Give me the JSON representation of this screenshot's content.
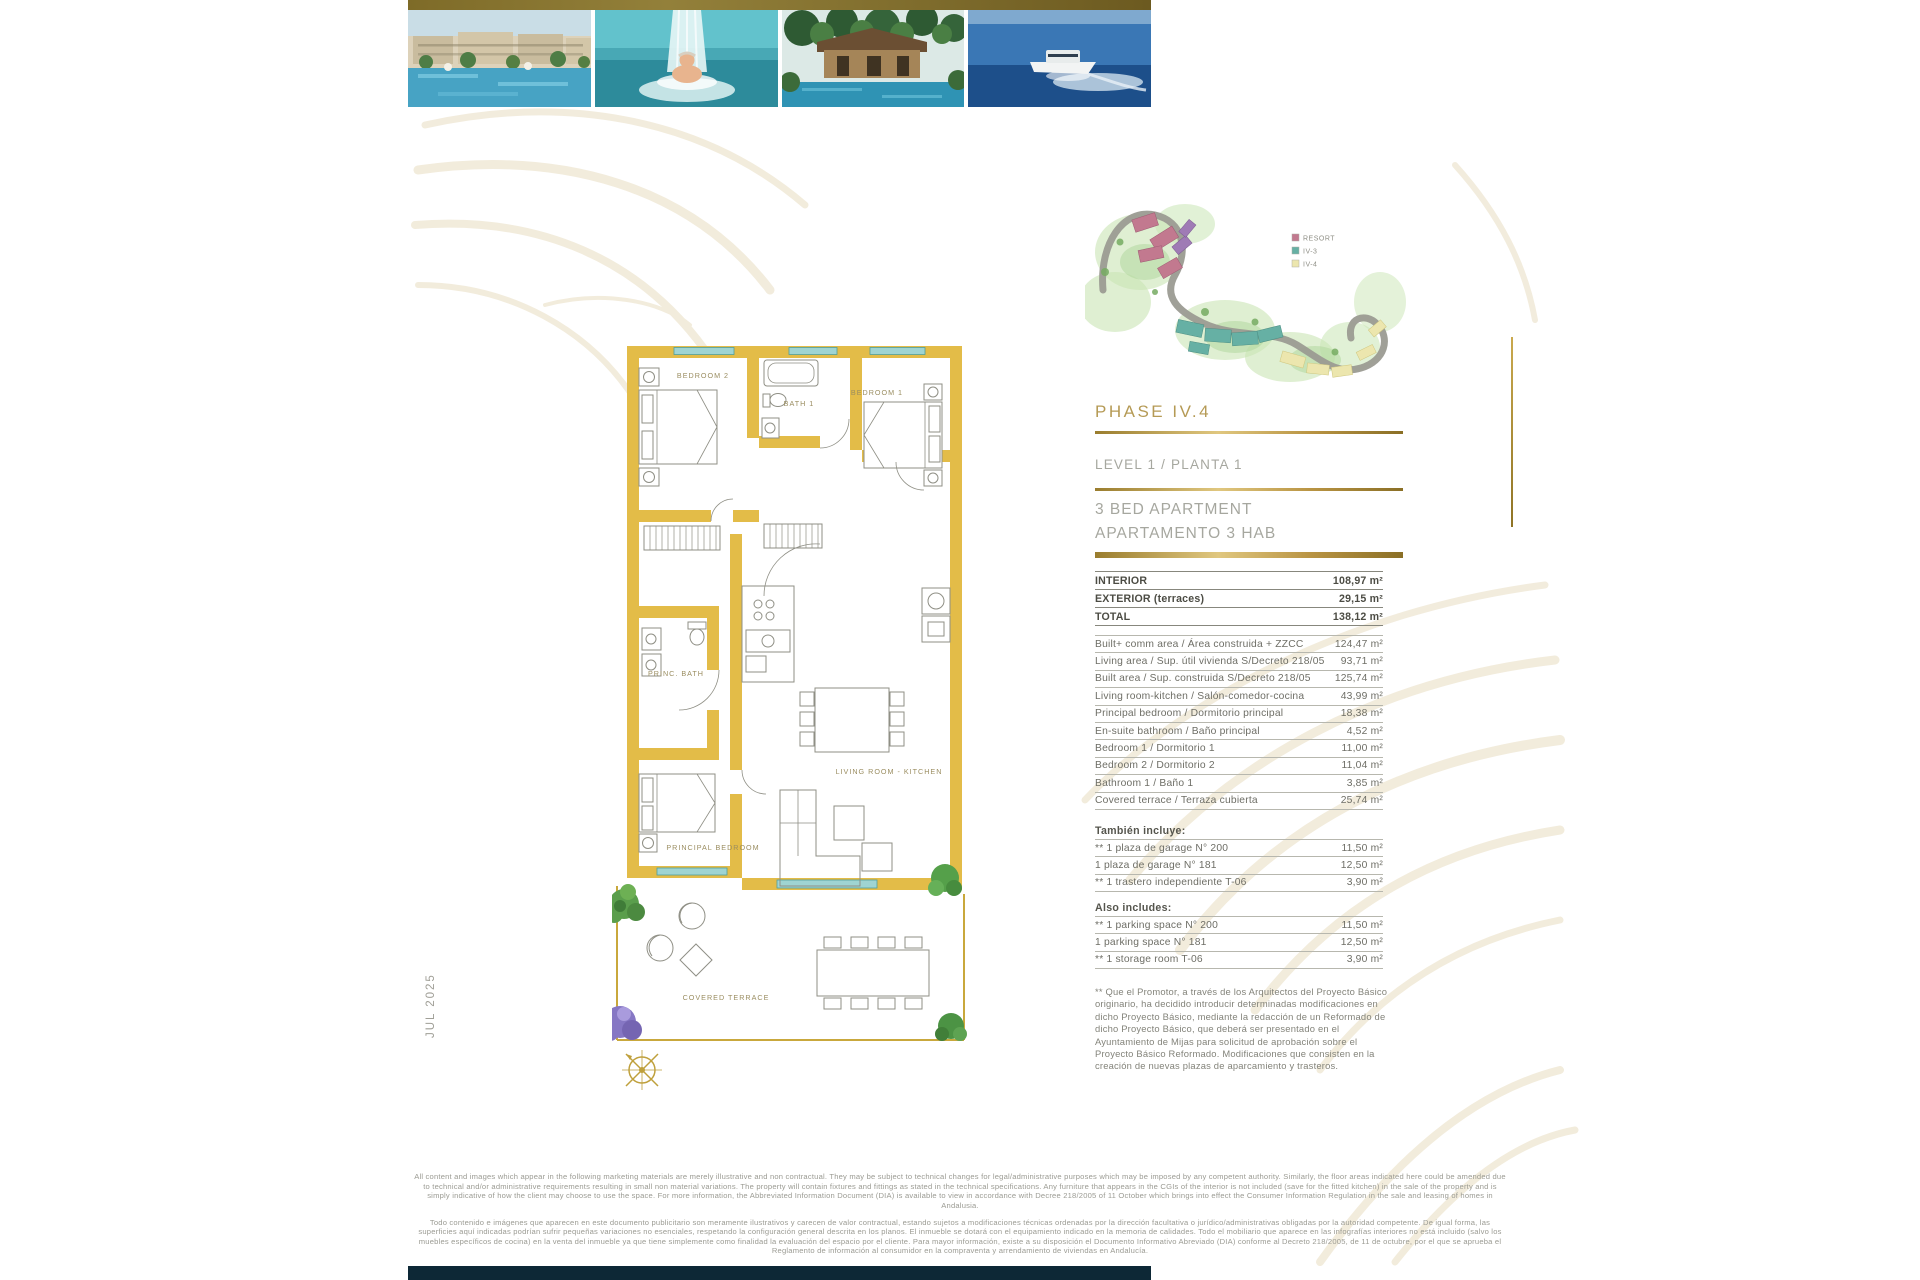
{
  "page": {
    "date_label": "JUL 2025"
  },
  "site_map": {
    "legend": [
      {
        "label": "RESORT",
        "color": "#c2798f"
      },
      {
        "label": "IV-3",
        "color": "#66b0a4"
      },
      {
        "label": "IV-4",
        "color": "#ece6ae"
      }
    ]
  },
  "headings": {
    "phase": "PHASE IV.4",
    "level": "LEVEL 1 / PLANTA 1",
    "unit_en": "3 BED APARTMENT",
    "unit_es": "APARTAMENTO 3 HAB"
  },
  "summary_table": {
    "rows": [
      {
        "label": "INTERIOR",
        "value": "108,97 m²"
      },
      {
        "label": "EXTERIOR (terraces)",
        "value": "29,15 m²"
      },
      {
        "label": "TOTAL",
        "value": "138,12 m²"
      }
    ]
  },
  "area_table": {
    "rows": [
      {
        "label": "Built+ comm area / Área construida + ZZCC",
        "value": "124,47 m²"
      },
      {
        "label": "Living area / Sup. útil vivienda S/Decreto 218/05",
        "value": "93,71 m²"
      },
      {
        "label": "Built area / Sup. construida S/Decreto 218/05",
        "value": "125,74 m²"
      },
      {
        "label": "Living room-kitchen / Salón-comedor-cocina",
        "value": "43,99 m²"
      },
      {
        "label": "Principal bedroom / Dormitorio principal",
        "value": "18,38 m²"
      },
      {
        "label": "En-suite bathroom / Baño principal",
        "value": "4,52 m²"
      },
      {
        "label": "Bedroom 1 / Dormitorio 1",
        "value": "11,00 m²"
      },
      {
        "label": "Bedroom 2 / Dormitorio 2",
        "value": "11,04 m²"
      },
      {
        "label": "Bathroom 1 / Baño 1",
        "value": "3,85 m²"
      },
      {
        "label": "Covered terrace / Terraza cubierta",
        "value": "25,74 m²"
      }
    ]
  },
  "tambien_incluye": {
    "heading": "También incluye:",
    "rows": [
      {
        "label": "** 1 plaza de garage N° 200",
        "value": "11,50 m²"
      },
      {
        "label": "1 plaza de garage N° 181",
        "value": "12,50 m²"
      },
      {
        "label": "** 1 trastero independiente T-06",
        "value": "3,90 m²"
      }
    ]
  },
  "also_includes": {
    "heading": "Also includes:",
    "rows": [
      {
        "label": "** 1 parking space N° 200",
        "value": "11,50 m²"
      },
      {
        "label": "1 parking space N° 181",
        "value": "12,50 m²"
      },
      {
        "label": "** 1 storage room T-06",
        "value": "3,90 m²"
      }
    ]
  },
  "footnote": "** Que el Promotor, a través de los Arquitectos del Proyecto Básico originario, ha decidido introducir determinadas modificaciones en dicho Proyecto Básico, mediante la redacción de un Reformado de dicho Proyecto Básico, que deberá ser presentado en el Ayuntamiento de Mijas para solicitud de aprobación sobre el Proyecto Básico Reformado. Modificaciones que consisten en la creación de nuevas plazas de aparcamiento y trasteros.",
  "floor_plan": {
    "labels": {
      "bedroom2": "BEDROOM 2",
      "bath1": "BATH 1",
      "bedroom1": "BEDROOM 1",
      "princ_bath": "PRINC. BATH",
      "principal_bedroom": "PRINCIPAL BEDROOM",
      "living": "LIVING ROOM - KITCHEN",
      "terrace": "COVERED TERRACE"
    }
  },
  "disclaimers": {
    "en": "All content and images which appear in the following marketing materials are merely illustrative and non contractual. They may be subject to technical changes for legal/administrative purposes which may be imposed by any competent authority. Similarly, the floor areas indicated here could be amended due to technical and/or administrative requirements resulting in small non material variations. The property will contain fixtures and fittings as stated in the technical specifications. Any furniture that appears in the CGIs of the interior is not included (save for the fitted kitchen) in the sale of the property and is simply indicative of how the client may choose to use the space. For more information, the Abbreviated Information Document (DIA) is available to view in accordance with Decree 218/2005 of 11 October which brings into effect the Consumer Information Regulation in the sale and leasing of homes in Andalusia.",
    "es": "Todo contenido e imágenes que aparecen en este documento publicitario son meramente ilustrativos y carecen de valor contractual, estando sujetos a modificaciones técnicas ordenadas por la dirección facultativa o jurídico/administrativas obligadas por la autoridad competente. De igual forma, las superficies aquí indicadas podrían sufrir pequeñas variaciones no esenciales, respetando la configuración general descrita en los planos. El inmueble se dotará con el equipamiento indicado en la memoria de calidades. Todo el mobiliario que aparece en las infografías interiores no está incluido (salvo los muebles específicos de cocina) en la venta del inmueble ya que tiene simplemente como finalidad la evaluación del espacio por el cliente. Para mayor información, existe a su disposición el Documento Informativo Abreviado (DIA) conforme al Decreto 218/2005, de 11 de octubre, por el que se aprueba el Reglamento de información al consumidor en la compraventa y arrendamiento de viviendas en Andalucía."
  }
}
